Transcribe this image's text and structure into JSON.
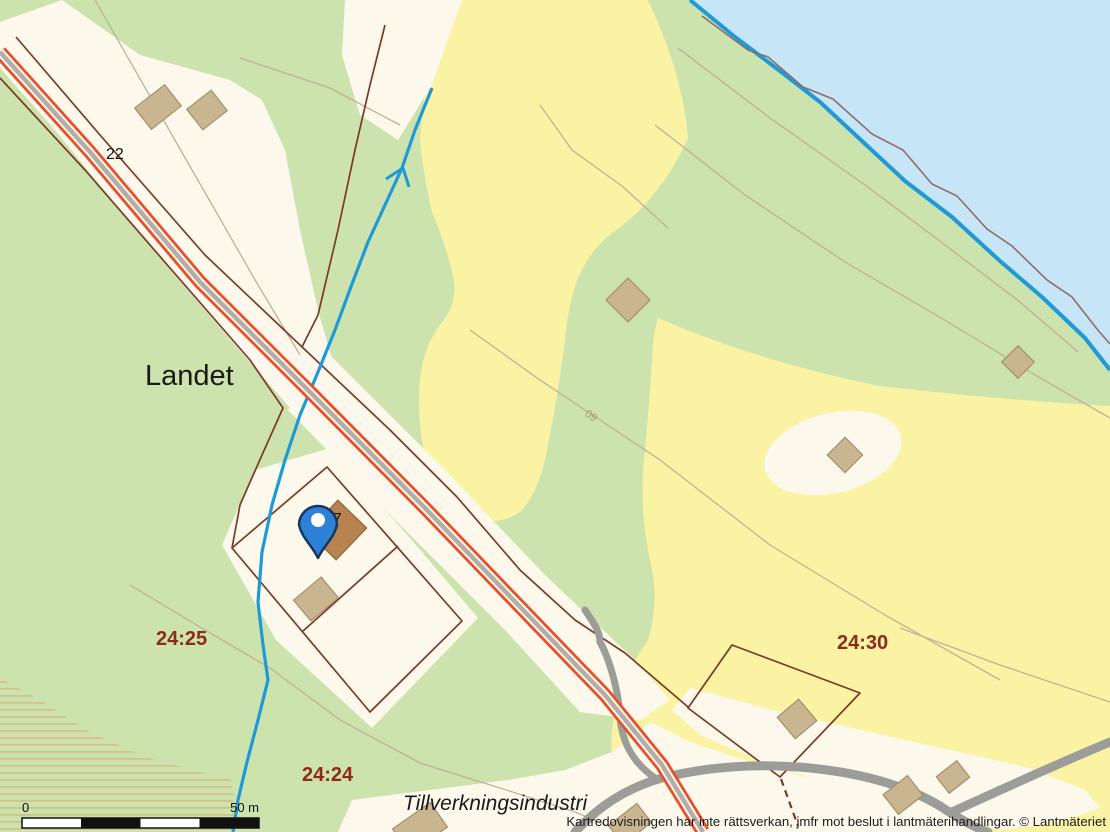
{
  "labels": {
    "place": "Landet",
    "road_number": "22",
    "house_number": "17",
    "contour": "60",
    "parcel_sw": "24:25",
    "parcel_s": "24:24",
    "parcel_e": "24:30",
    "land_use": "Tillverkningsindustri"
  },
  "scale_bar": {
    "start": "0",
    "end": "50 m"
  },
  "attribution": "Kartredovisningen har inte rättsverkan, jmfr mot beslut i lantmäterihandlingar. © Lantmäteriet",
  "marker": {
    "type": "map-pin",
    "color": "#2E81D6"
  },
  "colors": {
    "water": "#C6E5F7",
    "forest_green": "#CCE3AE",
    "field_yellow": "#FAF3A3",
    "open_land": "#FCF9EC",
    "road_major": "#E94E2B",
    "road_minor": "#9C9C99",
    "parcel_boundary": "#7B3A27",
    "parcel_label": "#8E2A1C",
    "stream": "#1E9AD6",
    "marker": "#2E81D6"
  }
}
